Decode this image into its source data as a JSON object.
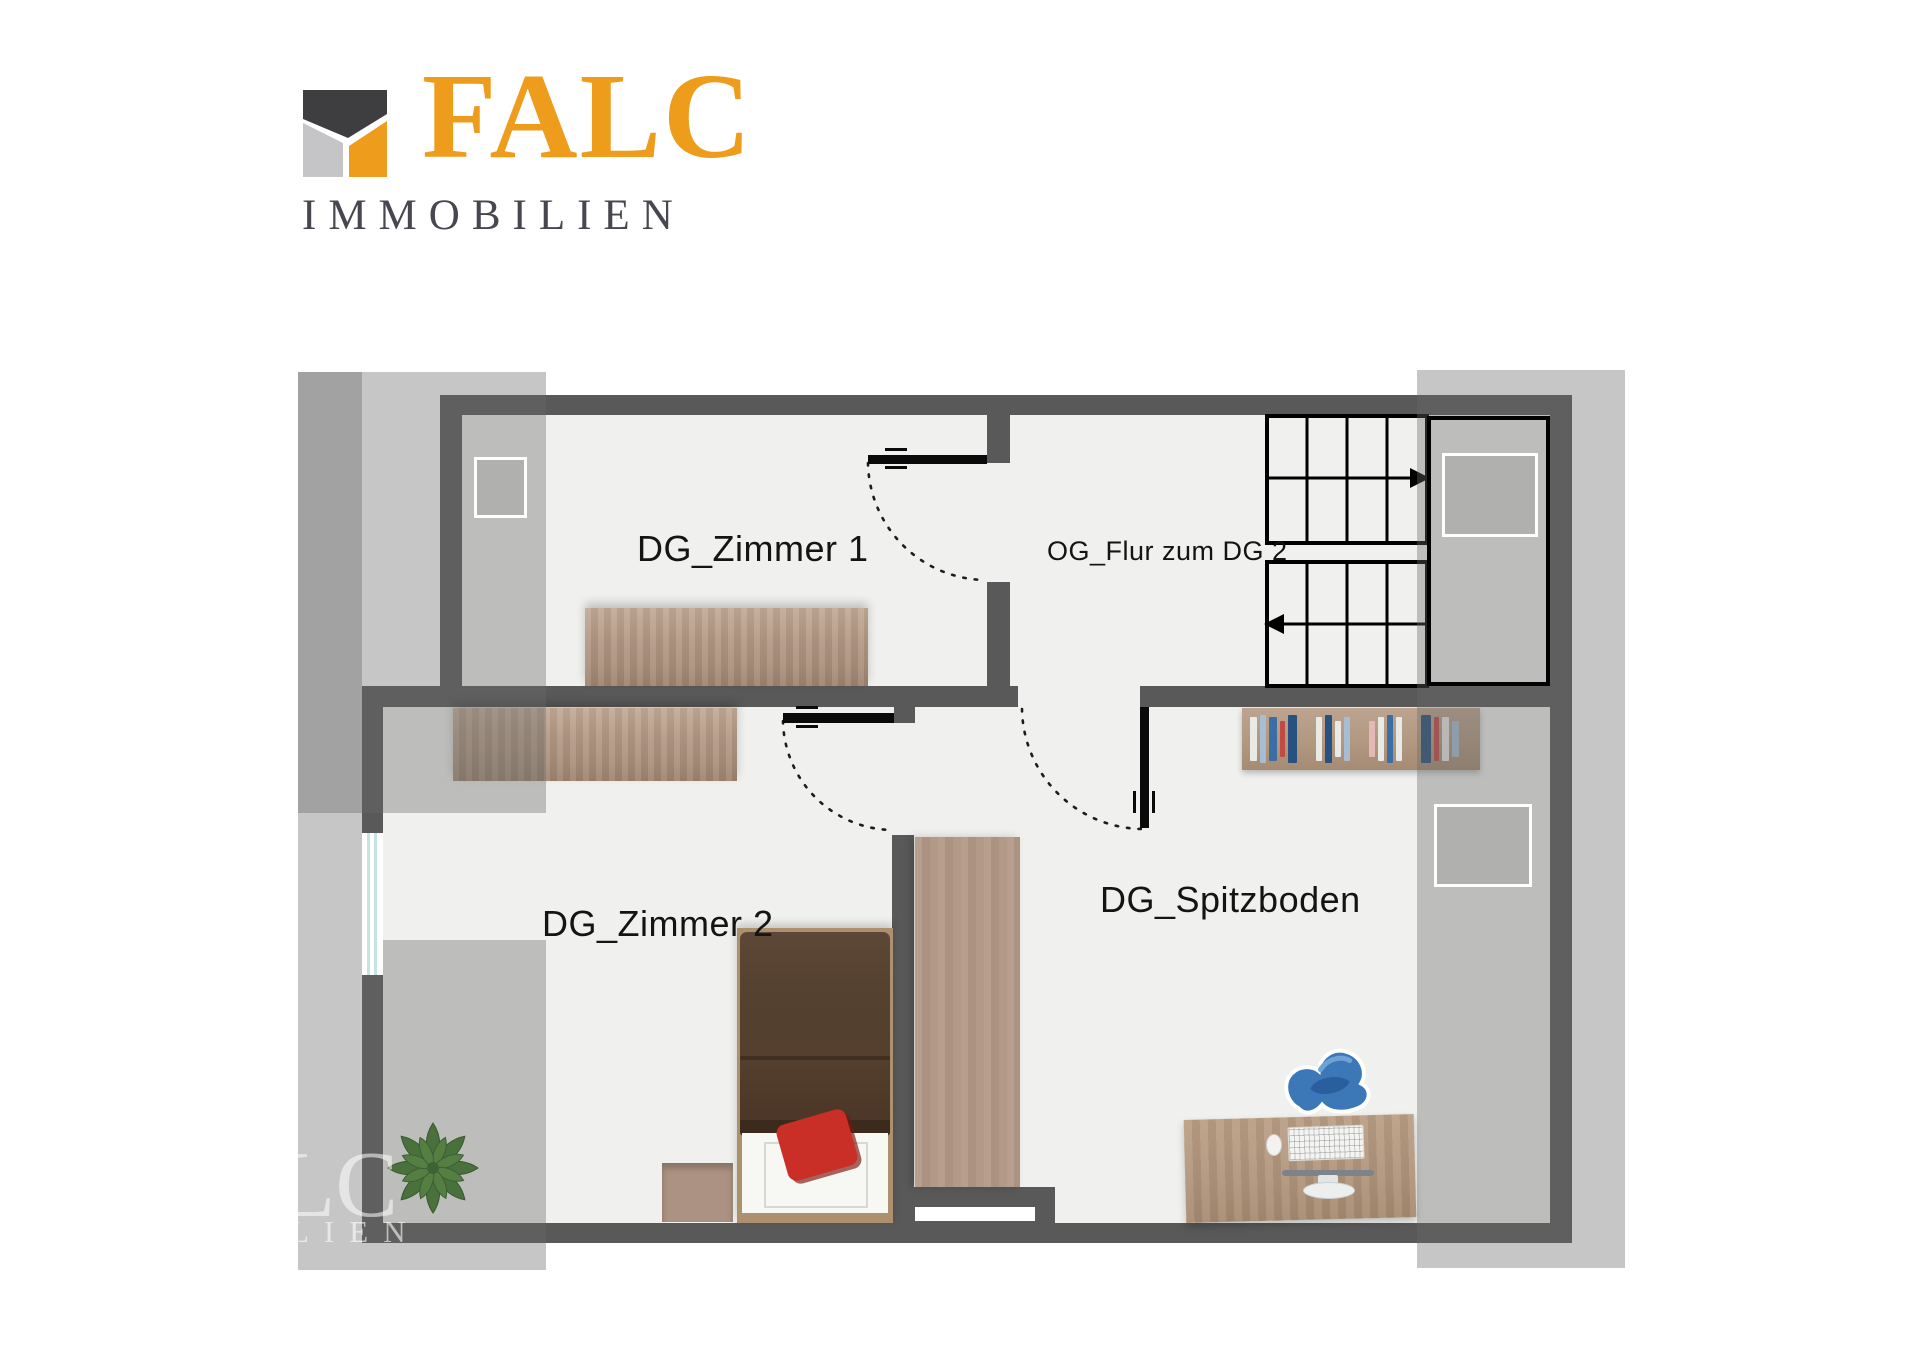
{
  "logo": {
    "brand": "FALC",
    "subtitle": "IMMOBILIEN",
    "icon": "falc-house-icon",
    "colors": {
      "orange": "#ee9c1c",
      "roof_dark": "#3e3e40",
      "left_light": "#c5c5c7",
      "subtitle_gray": "#474750"
    }
  },
  "plan": {
    "rooms": [
      {
        "id": "dg_zimmer_1",
        "label": "DG_Zimmer 1"
      },
      {
        "id": "og_flur",
        "label": "OG_Flur zum DG 2"
      },
      {
        "id": "dg_zimmer_2",
        "label": "DG_Zimmer 2"
      },
      {
        "id": "dg_spitzboden",
        "label": "DG_Spitzboden"
      }
    ],
    "colors": {
      "wall": "#595959",
      "floor": "#f0f0ee",
      "roof_overlay": "rgba(105,105,105,0.38)",
      "door": "#0a0a0a",
      "window_glass": "#c2e4e2",
      "plant_green": "#2f6b1e",
      "chair_blue": "#3c78b8",
      "pillow_red": "#c92f27",
      "wood": "#b59b87"
    },
    "stairs": {
      "flights": 2,
      "treads_per_flight": 4,
      "upper_arrow": "right",
      "lower_arrow": "left"
    },
    "furniture": [
      "desk",
      "desk",
      "bed",
      "nightstand",
      "plant",
      "wardrobe",
      "bookshelf",
      "office-desk",
      "office-chair",
      "keyboard",
      "monitor",
      "mouse"
    ],
    "skylights": 3,
    "windows": 2,
    "watermark": {
      "line1": "LC",
      "line2": "LIEN"
    }
  }
}
